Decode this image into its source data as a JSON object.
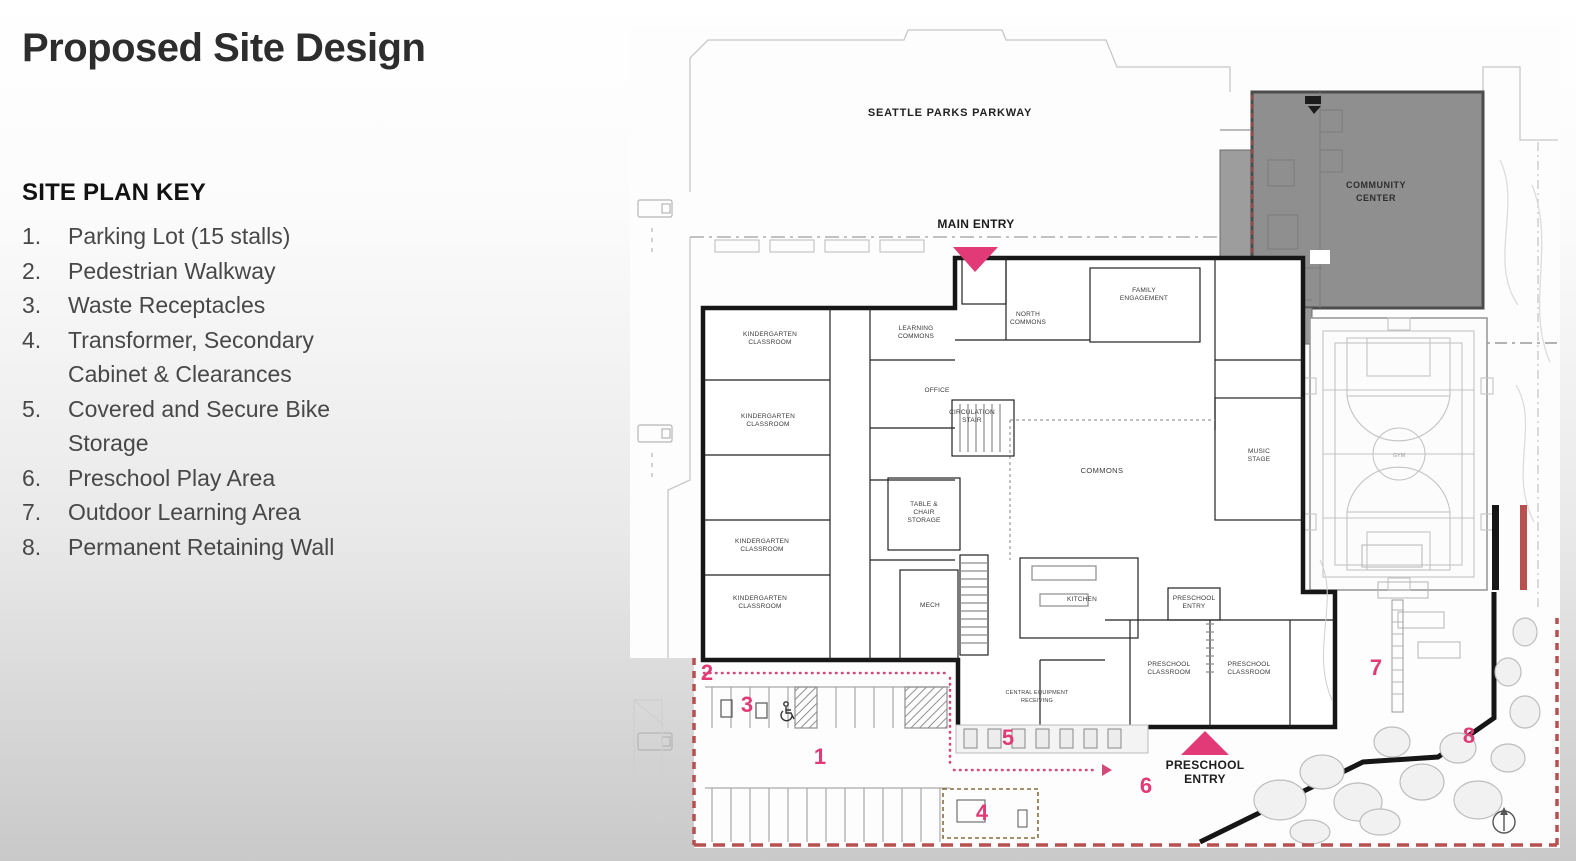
{
  "slide": {
    "title": "Proposed Site Design",
    "key": {
      "heading": "SITE PLAN KEY",
      "items": [
        {
          "num": "1.",
          "text": "Parking Lot (15 stalls)"
        },
        {
          "num": "2.",
          "text": "Pedestrian Walkway"
        },
        {
          "num": "3.",
          "text": "Waste Receptacles"
        },
        {
          "num": "4.",
          "text": "Transformer, Secondary Cabinet & Clearances"
        },
        {
          "num": "5.",
          "text": "Covered and Secure Bike Storage"
        },
        {
          "num": "6.",
          "text": "Preschool Play Area"
        },
        {
          "num": "7.",
          "text": "Outdoor Learning Area"
        },
        {
          "num": "8.",
          "text": "Permanent Retaining Wall"
        }
      ]
    }
  },
  "plan": {
    "street": "SEATTLE PARKS PARKWAY",
    "main_entry": "MAIN ENTRY",
    "preschool_entry1": "PRESCHOOL",
    "preschool_entry2": "ENTRY",
    "community_center1": "COMMUNITY",
    "community_center2": "CENTER",
    "gym": "GYM",
    "rooms": {
      "kindergarten1": "KINDERGARTEN",
      "kindergarten2": "CLASSROOM",
      "north_commons1": "NORTH",
      "north_commons2": "COMMONS",
      "family1": "FAMILY",
      "family2": "ENGAGEMENT",
      "circulation1": "CIRCULATION",
      "circulation2": "STAIR",
      "commons": "COMMONS",
      "music1": "MUSIC",
      "music2": "STAGE",
      "office": "OFFICE",
      "learning1": "LEARNING",
      "learning2": "COMMONS",
      "table1": "TABLE &",
      "table2": "CHAIR",
      "table3": "STORAGE",
      "mech": "MECH",
      "kitchen": "KITCHEN",
      "preschool1": "PRESCHOOL",
      "preschool2": "CLASSROOM",
      "preschool_entry_small1": "PRESCHOOL",
      "preschool_entry_small2": "ENTRY",
      "central1": "CENTRAL EQUIPMENT",
      "central2": "RECEIVING"
    },
    "markers": {
      "m1": "1",
      "m2": "2",
      "m3": "3",
      "m4": "4",
      "m5": "5",
      "m6": "6",
      "m7": "7",
      "m8": "8"
    },
    "colors": {
      "accent_pink": "#e23a76",
      "boundary_red": "#b85050",
      "building_gray": "#8f8f8f"
    }
  }
}
